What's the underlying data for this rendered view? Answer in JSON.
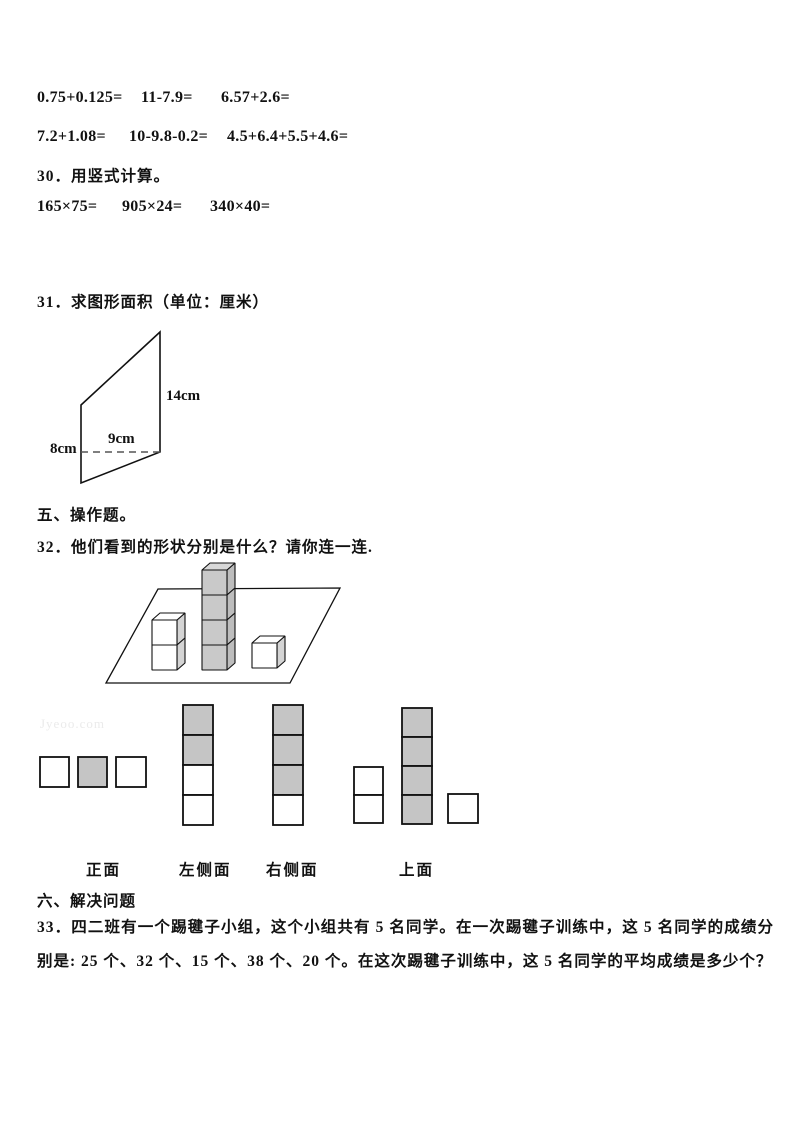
{
  "watermark": "Jyeoo.com",
  "calc_rows": {
    "row1": [
      "0.75+0.125=",
      "11-7.9=",
      "6.57+2.6="
    ],
    "row2": [
      "7.2+1.08=",
      "10-9.8-0.2=",
      "4.5+6.4+5.5+4.6="
    ]
  },
  "q30": {
    "title": "30．用竖式计算。",
    "items": [
      "165×75=",
      "905×24=",
      "340×40="
    ]
  },
  "q31": {
    "title": "31．求图形面积（单位：厘米）",
    "labels": {
      "right": "14cm",
      "base": "9cm",
      "left": "8cm"
    }
  },
  "section5": "五、操作题。",
  "q32": {
    "title": "32．他们看到的形状分别是什么？请你连一连."
  },
  "views": {
    "labels": [
      "正面",
      "左侧面",
      "右侧面",
      "上面"
    ]
  },
  "section6": "六、解决问题",
  "q33": "33．四二班有一个踢毽子小组，这个小组共有 5 名同学。在一次踢毽子训练中，这 5 名同学的成绩分别是: 25 个、32 个、15 个、38 个、20 个。在这次踢毽子训练中，这 5 名同学的平均成绩是多少个？",
  "colors": {
    "ink": "#111111",
    "square_gray": "#c5c5c5",
    "square_white": "#ffffff",
    "cube_gray_front": "#c9c9c9",
    "cube_gray_top": "#d8d8d8",
    "cube_gray_side": "#bdbdbd",
    "cube_white_side": "#d4d4d4",
    "watermark_gray": "#ebebeb"
  },
  "figures": {
    "scene": {
      "description": "plane with stacks of cubes: left stack 2 white, middle stack 4 gray, right 1 white",
      "stack_heights": [
        2,
        4,
        1
      ]
    },
    "view_options": [
      {
        "name": "option-row-of-3",
        "squares": [
          {
            "x": 40,
            "y": 62,
            "w": 29,
            "h": 30,
            "f": "w"
          },
          {
            "x": 78,
            "y": 62,
            "w": 29,
            "h": 30,
            "f": "g"
          },
          {
            "x": 116,
            "y": 62,
            "w": 30,
            "h": 30,
            "f": "w"
          }
        ]
      },
      {
        "name": "option-column-ggww",
        "squares": [
          {
            "x": 183,
            "y": 10,
            "w": 30,
            "h": 30,
            "f": "g"
          },
          {
            "x": 183,
            "y": 40,
            "w": 30,
            "h": 30,
            "f": "g"
          },
          {
            "x": 183,
            "y": 70,
            "w": 30,
            "h": 30,
            "f": "w"
          },
          {
            "x": 183,
            "y": 100,
            "w": 30,
            "h": 30,
            "f": "w"
          }
        ]
      },
      {
        "name": "option-column-gggw",
        "squares": [
          {
            "x": 273,
            "y": 10,
            "w": 30,
            "h": 30,
            "f": "g"
          },
          {
            "x": 273,
            "y": 40,
            "w": 30,
            "h": 30,
            "f": "g"
          },
          {
            "x": 273,
            "y": 70,
            "w": 30,
            "h": 30,
            "f": "g"
          },
          {
            "x": 273,
            "y": 100,
            "w": 30,
            "h": 30,
            "f": "w"
          }
        ]
      },
      {
        "name": "option-three-stacks",
        "squares": [
          {
            "x": 354,
            "y": 72,
            "w": 29,
            "h": 28,
            "f": "w"
          },
          {
            "x": 354,
            "y": 100,
            "w": 29,
            "h": 28,
            "f": "w"
          },
          {
            "x": 402,
            "y": 13,
            "w": 30,
            "h": 29,
            "f": "g"
          },
          {
            "x": 402,
            "y": 42,
            "w": 30,
            "h": 29,
            "f": "g"
          },
          {
            "x": 402,
            "y": 71,
            "w": 30,
            "h": 29,
            "f": "g"
          },
          {
            "x": 402,
            "y": 100,
            "w": 30,
            "h": 29,
            "f": "g"
          },
          {
            "x": 448,
            "y": 99,
            "w": 30,
            "h": 29,
            "f": "w"
          }
        ]
      }
    ]
  }
}
